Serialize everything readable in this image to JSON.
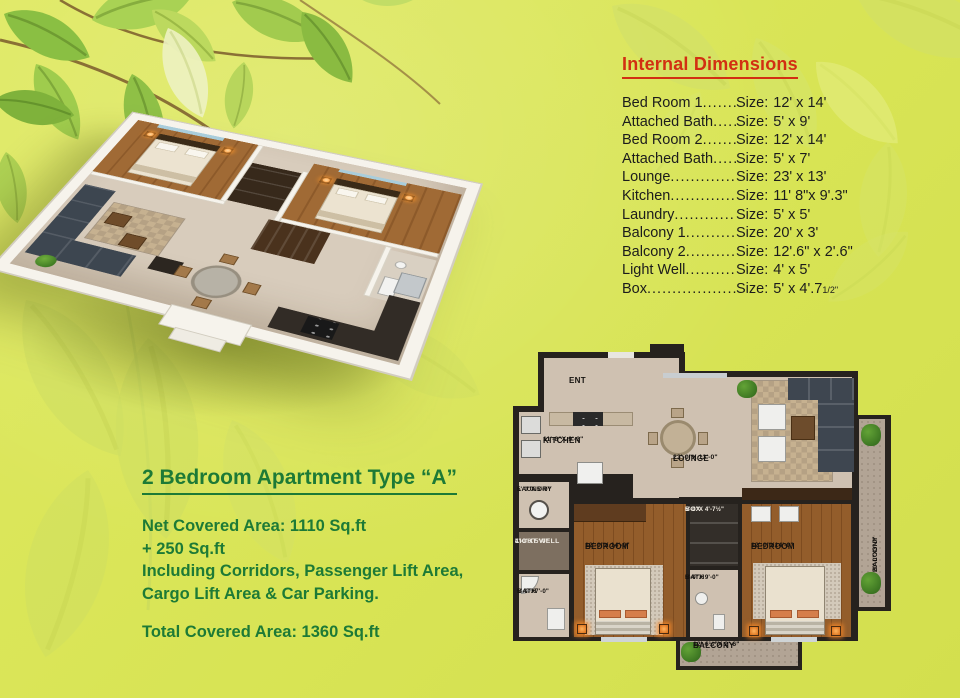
{
  "colors": {
    "background": "#dbe75c",
    "heading_red": "#d22f12",
    "text_dark": "#1c1c1c",
    "green_text": "#1d7a36",
    "wall_black": "#26221e",
    "floor_beige": "#cfc1b1",
    "floor_wood": "#8f5a28",
    "balcony_floor": "#b2a495",
    "sofa_dark": "#3e4650",
    "accent_orange": "#e08a4a"
  },
  "internal_dimensions": {
    "title": "Internal Dimensions",
    "size_prefix": "Size:",
    "leader_dots": "..............................................",
    "items": [
      {
        "label": "Bed Room 1",
        "size": "12' x 14'"
      },
      {
        "label": "Attached Bath",
        "size": "5' x 9'"
      },
      {
        "label": "Bed Room 2",
        "size": "12' x 14'"
      },
      {
        "label": "Attached Bath",
        "size": "5' x 7'"
      },
      {
        "label": "Lounge",
        "size": "23' x 13'"
      },
      {
        "label": "Kitchen",
        "size": "11' 8\"x 9'.3\""
      },
      {
        "label": "Laundry",
        "size": "5' x 5'"
      },
      {
        "label": "Balcony 1",
        "size": "20' x 3'"
      },
      {
        "label": "Balcony 2",
        "size": "12'.6\" x 2'.6\""
      },
      {
        "label": "Light Well",
        "size": "4' x 5'"
      },
      {
        "label": "Box",
        "size": "5' x 4'.7",
        "size_suffix_small": "1/2\""
      }
    ]
  },
  "apartment": {
    "title": "2 Bedroom Apartment Type “A”",
    "net_line": "Net Covered Area: 1110 Sq.ft",
    "plus_line": "+ 250 Sq.ft",
    "including_line1": "Including Corridors, Passenger Lift Area,",
    "including_line2": "Cargo Lift Area & Car Parking.",
    "total_line": "Total Covered Area: 1360 Sq.ft"
  },
  "plan2d": {
    "ent": "ENT",
    "kitchen": {
      "name": "KITCHEN",
      "dim": "11'-8\"X 9'-3\""
    },
    "laundry": {
      "name": "LAUNDRY",
      "dim": "5'-0\"X 5'-0\""
    },
    "light_well": {
      "name": "LIGHT WELL",
      "dim": "4'-0\"X 5'-0\""
    },
    "bath1": {
      "name": "BATH",
      "dim": "5'-0\"X7'-0\""
    },
    "bedroom1": {
      "name": "BEDROOM",
      "dim": "12'-0\"X 14'-0\""
    },
    "box": {
      "name": "BOX",
      "dim": "5'-0\"X 4'-7½\""
    },
    "bath2": {
      "name": "BATH",
      "dim": "5'-0\"X 9'-0\""
    },
    "bedroom2": {
      "name": "BEDROOM",
      "dim": "12'-0\"X14'-0\""
    },
    "lounge": {
      "name": "LOUNGE",
      "dim": "23'-0\"X 13'-0\""
    },
    "balcony_right": {
      "name": "BALCONY",
      "dim": "20'-0\"X3'-0\""
    },
    "balcony_bottom": {
      "name": "BALCONY",
      "dim": "12'-6½\"X 2'-6\""
    }
  }
}
